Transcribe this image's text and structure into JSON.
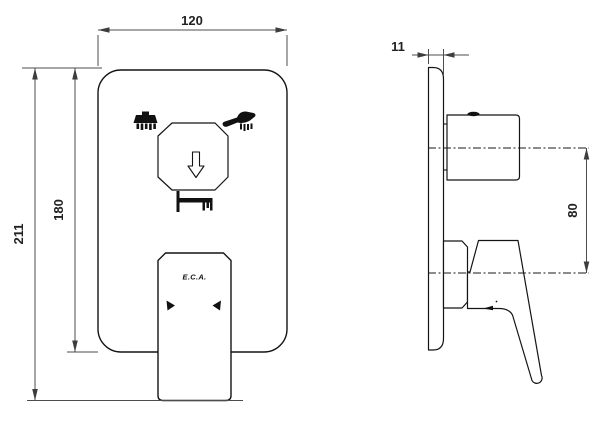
{
  "drawing": {
    "type": "technical-dimension-drawing",
    "views": [
      "front-view",
      "side-view"
    ],
    "dimensions": {
      "front_width": "120",
      "front_plate_height": "180",
      "front_total_height": "211",
      "side_depth": "11",
      "side_center_distance": "80"
    },
    "front_view": {
      "logo": "E.C.A.",
      "icons": [
        "overhead-shower-icon",
        "hand-shower-icon",
        "diverter-down-arrow-icon",
        "bath-spout-icon",
        "left-indicator-triangle-icon",
        "right-indicator-triangle-icon"
      ]
    },
    "colors": {
      "outline": "#141414",
      "dimension_line": "#4d4d4d",
      "background": "#ffffff"
    }
  }
}
